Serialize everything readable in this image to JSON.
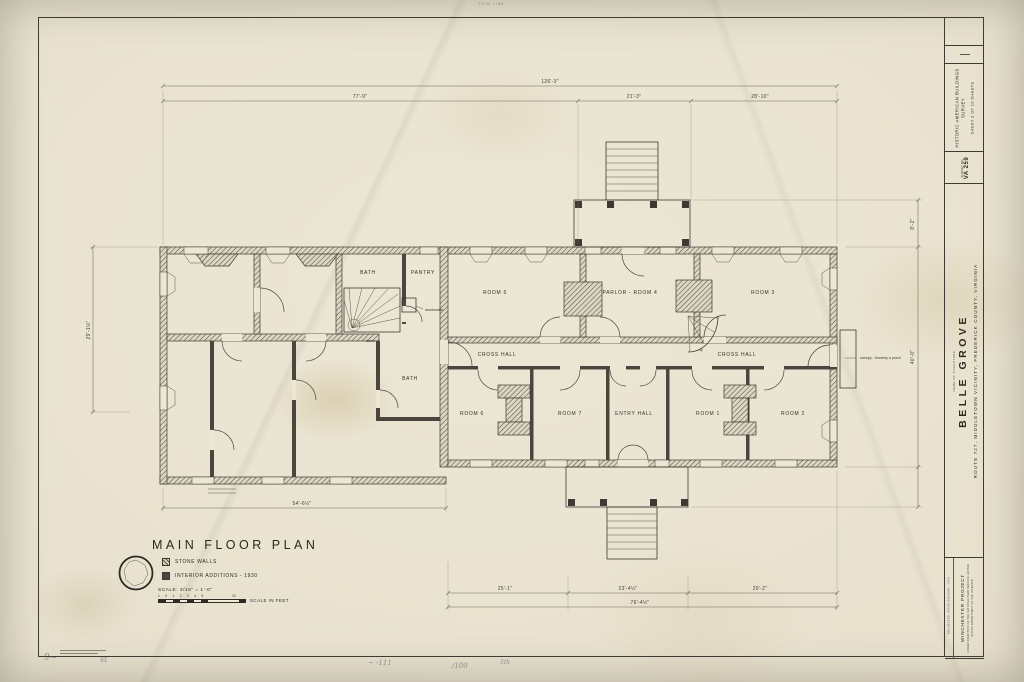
{
  "sheet": {
    "trim_label": "TRIM LINE",
    "title_block": {
      "survey_title": "HISTORIC AMERICAN BUILDINGS SURVEY",
      "sheet_info": "SHEET 3 OF 10 SHEETS",
      "survey_no_label": "SURVEY NO.",
      "survey_no": "VA 259",
      "name_label": "NAME OF STRUCTURE",
      "structure_name": "BELLE GROVE",
      "location": "ROUTE 727,   MIDDLETOWN VICINITY,   FREDERICK COUNTY,   VIRGINIA",
      "project": "WINCHESTER PROJECT",
      "project_note": "UNDER DIRECTION OF THE NATIONAL PARK SERVICE, UNITED STATES DEPARTMENT OF THE INTERIOR",
      "delineator_note": "DELINEATED: STEVE HORNSBY - 1973"
    },
    "plan": {
      "title": "MAIN FLOOR PLAN",
      "legend": {
        "stone_walls": "STONE WALLS",
        "interior_additions": "INTERIOR ADDITIONS - 1930"
      },
      "scale_note": "SCALE: 3/16\" = 1'-0\"",
      "scale_ticks_left": "1 0 1 2 3 4 5",
      "scale_ticks_right": "10",
      "scale_bar_label": "SCALE IN FEET",
      "rooms": {
        "bath_upper": "BATH",
        "pantry": "PANTRY",
        "bath_lower": "BATH",
        "room5": "ROOM 5",
        "parlor4": "PARLOR - ROOM 4",
        "room3": "ROOM 3",
        "cross_hall_west": "CROSS HALL",
        "cross_hall_east": "CROSS HALL",
        "room6": "ROOM 6",
        "room7": "ROOM 7",
        "entry_hall": "ENTRY HALL",
        "room1": "ROOM 1",
        "room2": "ROOM 2"
      },
      "annotations": {
        "down": "down",
        "up": "up",
        "dumbwaiter": "dumbwaiter",
        "canopy_note": "canopy - formerly a porch"
      },
      "dimensions": {
        "overall_width": "126'-3\"",
        "seg_west": "77'-9\"",
        "seg_portico": "21'-3\"",
        "seg_east": "28'-10\"",
        "west_depth": "29'-1½\"",
        "wing_length": "54'-6½\"",
        "south_a": "25'-1\"",
        "south_b": "23'-4½\"",
        "south_c": "29'-2\"",
        "south_total": "76'-4½\"",
        "east_portico": "8'-2\"",
        "east_depth": "40'-0\""
      }
    },
    "handwritten": {
      "m1": "9~",
      "m2": "st",
      "m3": "~ -111",
      "m4": "/100",
      "m5": "5th"
    }
  }
}
